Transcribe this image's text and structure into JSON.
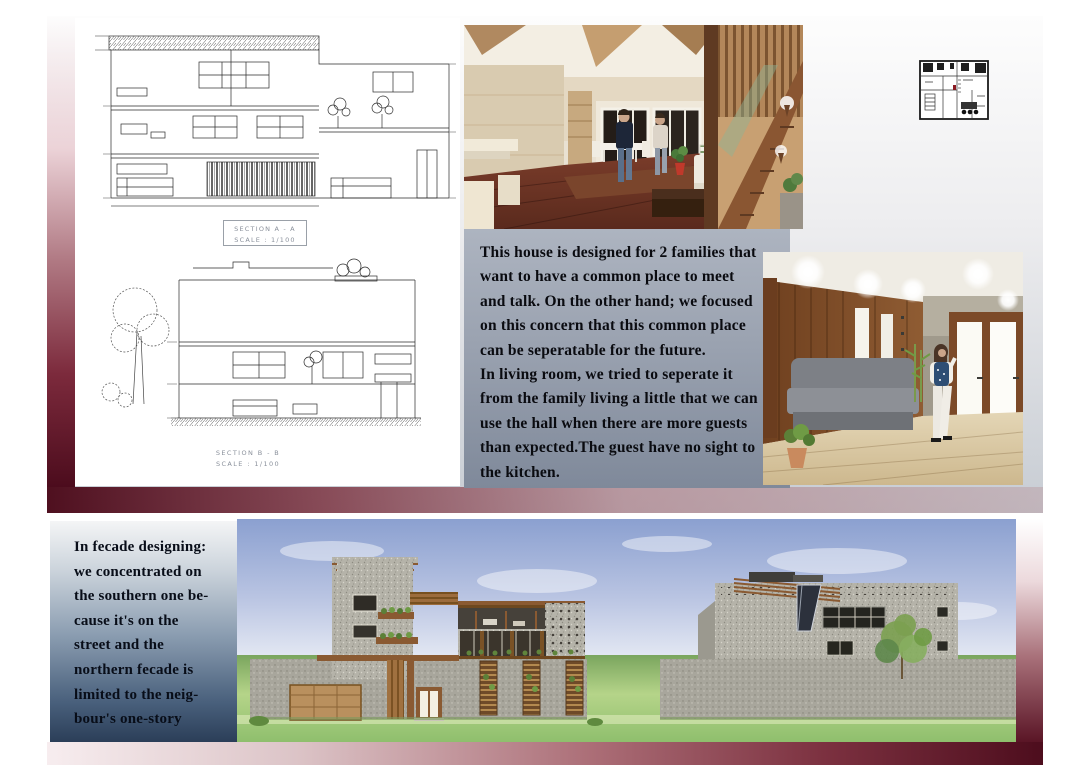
{
  "upper_panel": {
    "section_a": {
      "title": "SECTION A - A",
      "scale": "SCALE : 1/100"
    },
    "section_b": {
      "title": "SECTION B - B",
      "scale": "SCALE : 1/100"
    },
    "description": "This house is designed for 2 families that\nwant to have a common place to meet\nand talk. On the other hand; we focused\non this concern that this common place\ncan be seperatable for the future.\nIn living room, we tried to seperate it\nfrom the family living a little that we can\nuse the hall when there are more guests\nthan expected.The guest have no sight to\nthe kitchen."
  },
  "lower_panel": {
    "facade_note": "In fecade designing:\nwe concentrated on\nthe southern one be-\ncause it's on the\nstreet and the\nnorthern fecade is\nlimited to the neig-\nbour's one-story"
  },
  "colors": {
    "maroon_accent": "#4c0c1d",
    "panel_blue_gray": "#9aa2b0",
    "note_navy": "#2b3e58"
  }
}
